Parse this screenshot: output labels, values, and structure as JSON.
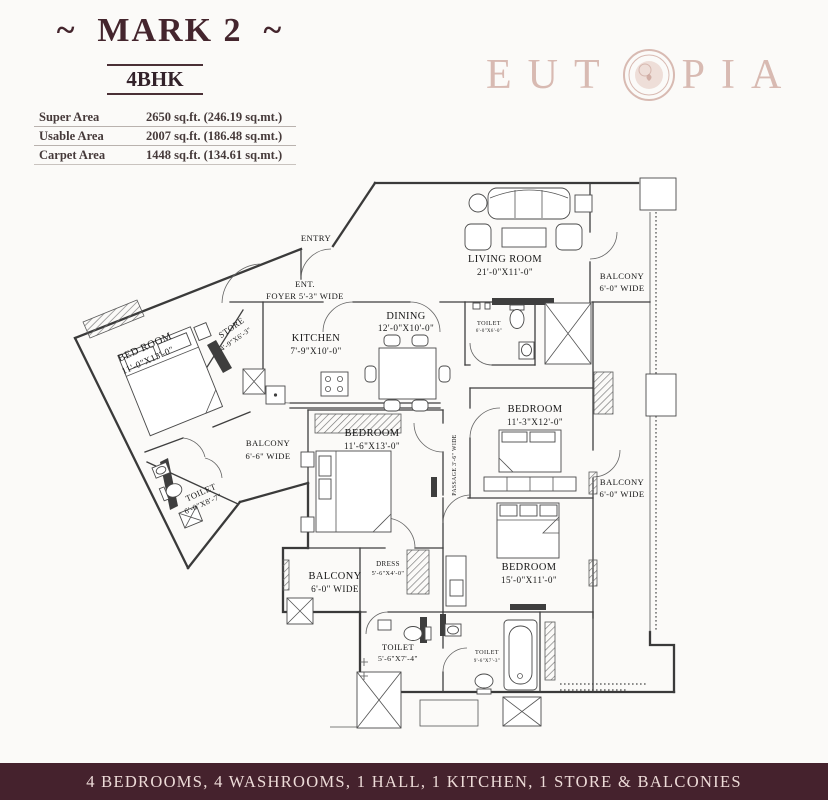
{
  "header": {
    "title": "~  MARK 2  ~",
    "unit_type": "4BHK",
    "areas": [
      {
        "label": "Super Area",
        "value": "2650 sq.ft. (246.19 sq.mt.)"
      },
      {
        "label": "Usable Area",
        "value": "2007 sq.ft. (186.48 sq.mt.)"
      },
      {
        "label": "Carpet Area",
        "value": "1448 sq.ft. (134.61 sq.mt.)"
      }
    ]
  },
  "brand": {
    "prefix": "EUT",
    "suffix": "PIA"
  },
  "plan": {
    "entry": "ENTRY",
    "foyer1": "ENT.",
    "foyer2": "FOYER 5'-3\" WIDE",
    "living1": "LIVING ROOM",
    "living2": "21'-0\"X11'-0\"",
    "balcony_tr1": "BALCONY",
    "balcony_tr2": "6'-0\" WIDE",
    "toilet_lv1": "TOILET",
    "toilet_lv2": "6'-0\"X6'-0\"",
    "dining1": "DINING",
    "dining2": "12'-0\"X10'-0\"",
    "kitchen1": "KITCHEN",
    "kitchen2": "7'-9\"X10'-0\"",
    "store1": "STORE",
    "store2": "4'-9\"X6'-3\"",
    "bedroom1a": "BED ROOM",
    "bedroom1b": "11'-0\"X13'-0\"",
    "balcony_w1": "BALCONY",
    "balcony_w2": "6'-6\" WIDE",
    "toilet_w1": "TOILET",
    "toilet_w2": "6'-0\"X8'-7\"",
    "bedroom2a": "BEDROOM",
    "bedroom2b": "11'-6\"X13'-0\"",
    "passage": "PASSAGE 3'-6\" WIDE",
    "bedroom3a": "BEDROOM",
    "bedroom3b": "11'-3\"X12'-0\"",
    "balcony_mr1": "BALCONY",
    "balcony_mr2": "6'-0\" WIDE",
    "bedroom4a": "BEDROOM",
    "bedroom4b": "15'-0\"X11'-0\"",
    "dress1": "DRESS",
    "dress2": "5'-6\"X4'-0\"",
    "balcony_bl1": "BALCONY",
    "balcony_bl2": "6'-0\" WIDE",
    "toilet2a": "TOILET",
    "toilet2b": "5'-6\"X7'-4\"",
    "toilet3a": "TOILET",
    "toilet3b": "9'-6\"X7'-3\""
  },
  "footer": {
    "summary": "4 BEDROOMS, 4 WASHROOMS, 1 HALL, 1 KITCHEN, 1 STORE & BALCONIES"
  },
  "colors": {
    "title": "#44252d",
    "brand": "#d8bab2",
    "footer_bg": "#45222d",
    "footer_text": "#eddbd8",
    "line": "#3a3a3a"
  }
}
